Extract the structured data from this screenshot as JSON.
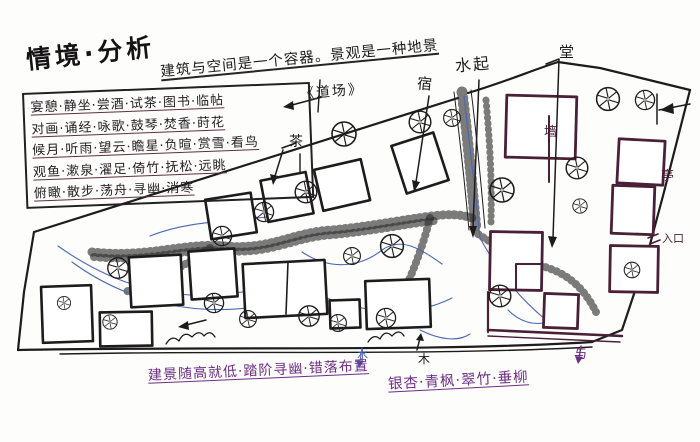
{
  "title": "情境·分析",
  "concept": {
    "note": "建筑与空间是一个容器。景观是一种地景",
    "tag": "《道场》"
  },
  "activity_table": {
    "rows": [
      "宴憩·静坐·尝酒·试茶·图书·临帖",
      "对画·诵经·咏歌·鼓琴·焚香·莳花",
      "候月·听雨·望云·瞻星·负暄·赏雪·看鸟",
      "观鱼·漱泉·濯足·倚竹·抚松·远眺",
      "俯瞰·散步·荡舟·寻幽·消寒"
    ]
  },
  "labels": {
    "water_start": "水起",
    "hall": "堂",
    "lodge": "宿",
    "tea": "茶",
    "wall": "墙",
    "pavilion": "亭",
    "entrance": "入口",
    "wood": "木",
    "water": "水",
    "corner_mark": "与"
  },
  "notes": {
    "terrain": "建景随高就低·踏阶寻幽·错落布置",
    "plants": "银杏·青枫·翠竹·垂柳"
  },
  "colors": {
    "ink": "#1d1b1c",
    "maroon": "#4a2036",
    "blue": "#4a67b3",
    "purple": "#6d2e84"
  }
}
